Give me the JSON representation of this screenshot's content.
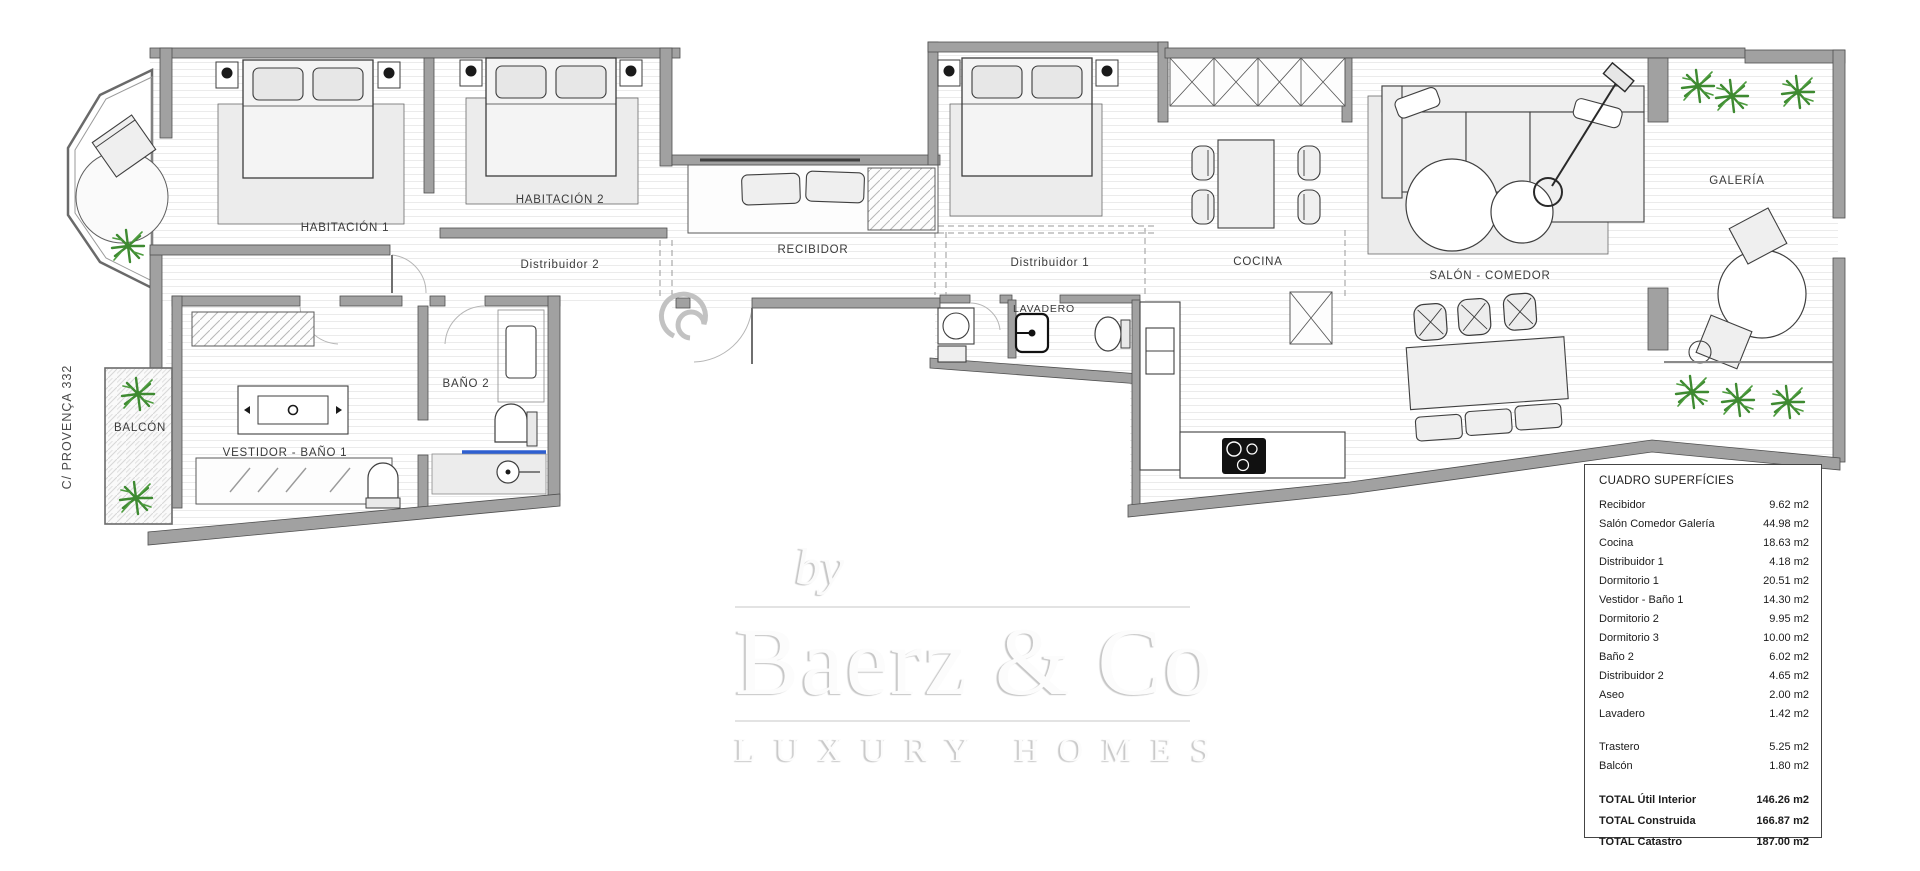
{
  "plan": {
    "street_label": "C/ PROVENÇA 332",
    "rooms": {
      "habitacion1": "HABITACIÓN 1",
      "habitacion2": "HABITACIÓN 2",
      "distribuidor2": "Distribuidor 2",
      "recibidor": "RECIBIDOR",
      "distribuidor1": "Distribuidor 1",
      "lavadero": "LAVADERO",
      "cocina": "COCINA",
      "salon_comedor": "SALÓN - COMEDOR",
      "galeria": "GALERÍA",
      "balcon": "BALCÓN",
      "vestidor_bano1": "VESTIDOR - BAÑO 1",
      "bano2": "BAÑO 2"
    }
  },
  "watermark": {
    "prefix": "by",
    "brand": "Baerz & Co",
    "tagline": "LUXURY HOMES"
  },
  "surfaces_table": {
    "title": "CUADRO SUPERFÍCIES",
    "rows": [
      {
        "label": "Recibidor",
        "value": "9.62 m2"
      },
      {
        "label": "Salón Comedor Galería",
        "value": "44.98 m2"
      },
      {
        "label": "Cocina",
        "value": "18.63 m2"
      },
      {
        "label": "Distribuidor 1",
        "value": "4.18 m2"
      },
      {
        "label": "Dormitorio 1",
        "value": "20.51 m2"
      },
      {
        "label": "Vestidor - Baño 1",
        "value": "14.30 m2"
      },
      {
        "label": "Dormitorio 2",
        "value": "9.95 m2"
      },
      {
        "label": "Dormitorio 3",
        "value": "10.00 m2"
      },
      {
        "label": "Baño 2",
        "value": "6.02 m2"
      },
      {
        "label": "Distribuidor 2",
        "value": "4.65 m2"
      },
      {
        "label": "Aseo",
        "value": "2.00 m2"
      },
      {
        "label": "Lavadero",
        "value": "1.42 m2"
      }
    ],
    "storage_rows": [
      {
        "label": "Trastero",
        "value": "5.25 m2"
      },
      {
        "label": "Balcón",
        "value": "1.80 m2"
      }
    ],
    "totals": [
      {
        "label": "TOTAL Útil Interior",
        "value": "146.26 m2"
      },
      {
        "label": "TOTAL Construida",
        "value": "166.87 m2"
      },
      {
        "label": "TOTAL Catastro",
        "value": "187.00 m2"
      }
    ]
  },
  "colors": {
    "wall_gray": "#a1a1a1",
    "floor_line": "#ebebeb",
    "plant_green": "#3e8a31",
    "shower_blue": "#2e5fd0"
  }
}
